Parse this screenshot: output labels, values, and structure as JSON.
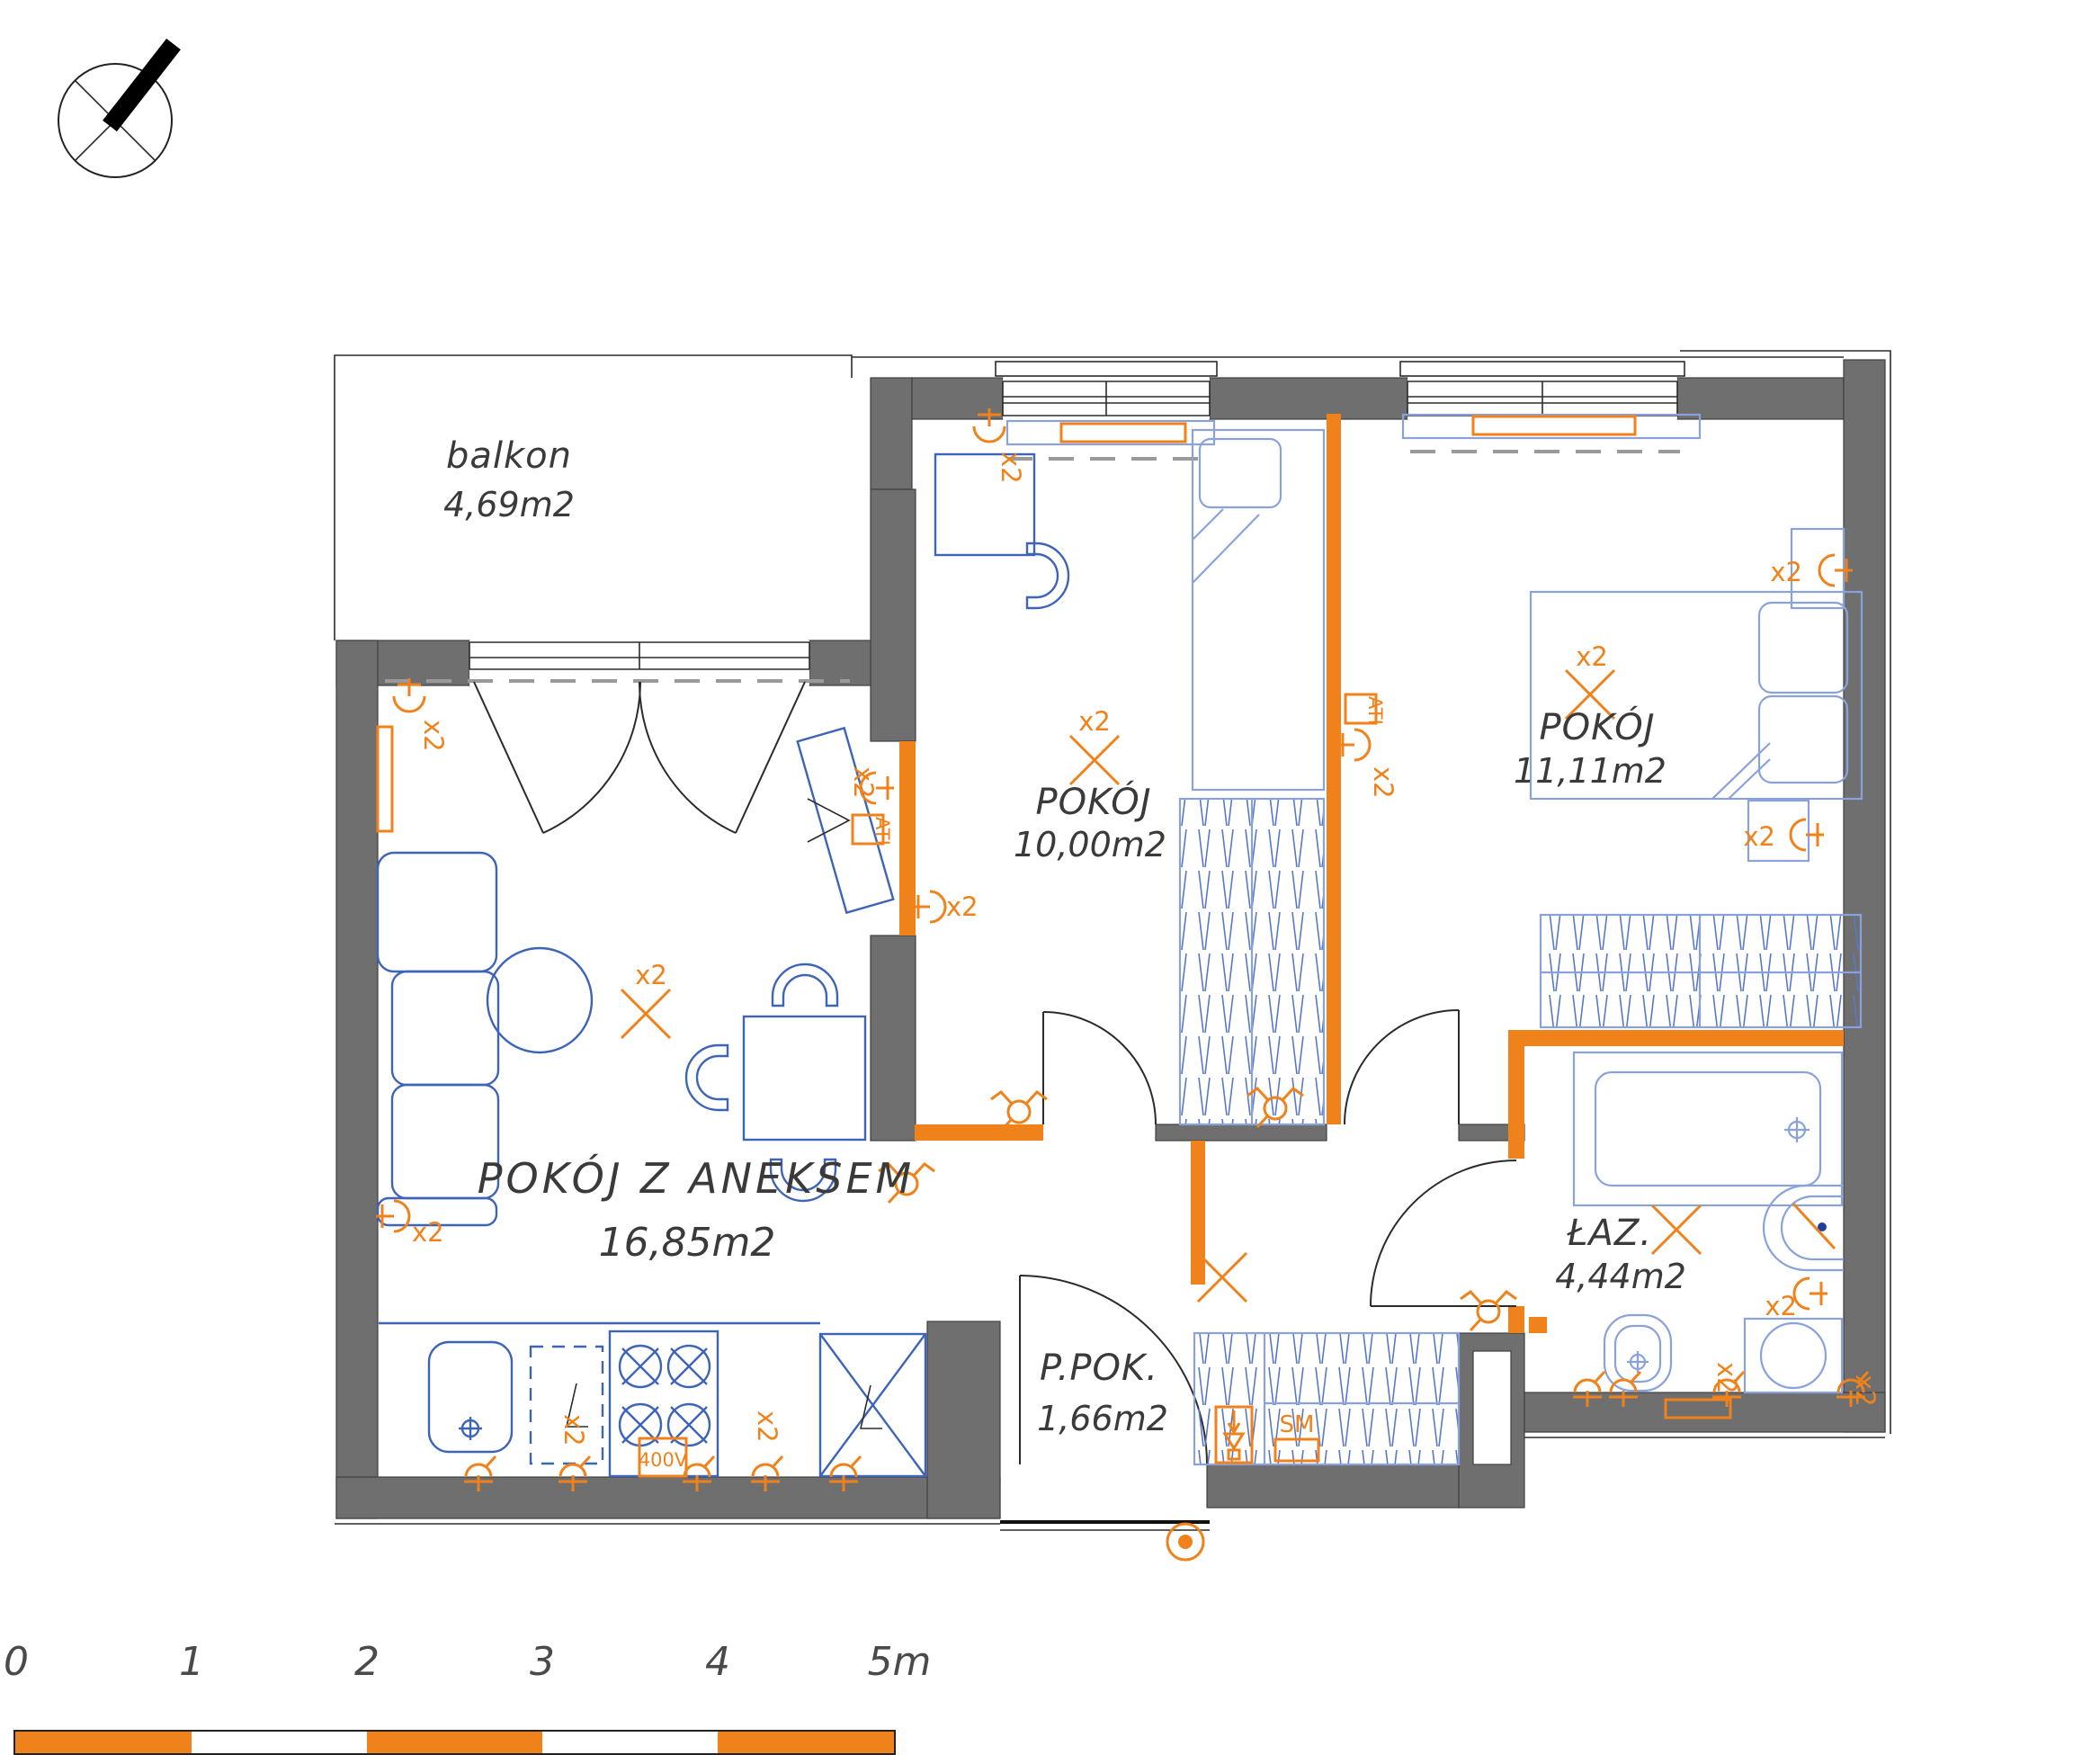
{
  "title": "apartment floor plan with electrical layout",
  "rooms": [
    {
      "name": "balkon",
      "area": "4,69m2"
    },
    {
      "name": "POKÓJ",
      "area": "10,00m2"
    },
    {
      "name": "POKÓJ",
      "area": "11,11m2"
    },
    {
      "name": "POKÓJ Z ANEKSEM",
      "area": "16,85m2"
    },
    {
      "name": "ŁAZ.",
      "area": "4,44m2"
    },
    {
      "name": "P.POK.",
      "area": "1,66m2"
    }
  ],
  "labels": {
    "x2": "x2",
    "ati": "ATI",
    "sm": "SM",
    "v400": "400V"
  },
  "scale": {
    "unit": "m",
    "ticks": [
      {
        "label": "0"
      },
      {
        "label": "1"
      },
      {
        "label": "2"
      },
      {
        "label": "3"
      },
      {
        "label": "4"
      },
      {
        "label": "5m"
      }
    ]
  },
  "colors": {
    "accent": "#F0821C",
    "wall": "#6F6F6F",
    "furniture": "#3E64B8",
    "furniture_light": "#8AA2DC"
  },
  "legend": {
    "symbols": [
      {
        "icon": "compass-icon",
        "meaning": "north arrow"
      },
      {
        "icon": "ceiling-light-icon",
        "meaning": "ceiling light point (X)"
      },
      {
        "icon": "wall-light-icon",
        "meaning": "wall light / lamp outlet"
      },
      {
        "icon": "socket-icon",
        "meaning": "power socket"
      },
      {
        "icon": "switch-icon",
        "meaning": "switch / sensor"
      },
      {
        "icon": "doorbell-icon",
        "meaning": "doorbell"
      },
      {
        "icon": "vent-icon",
        "meaning": "ventilation duct"
      }
    ]
  }
}
